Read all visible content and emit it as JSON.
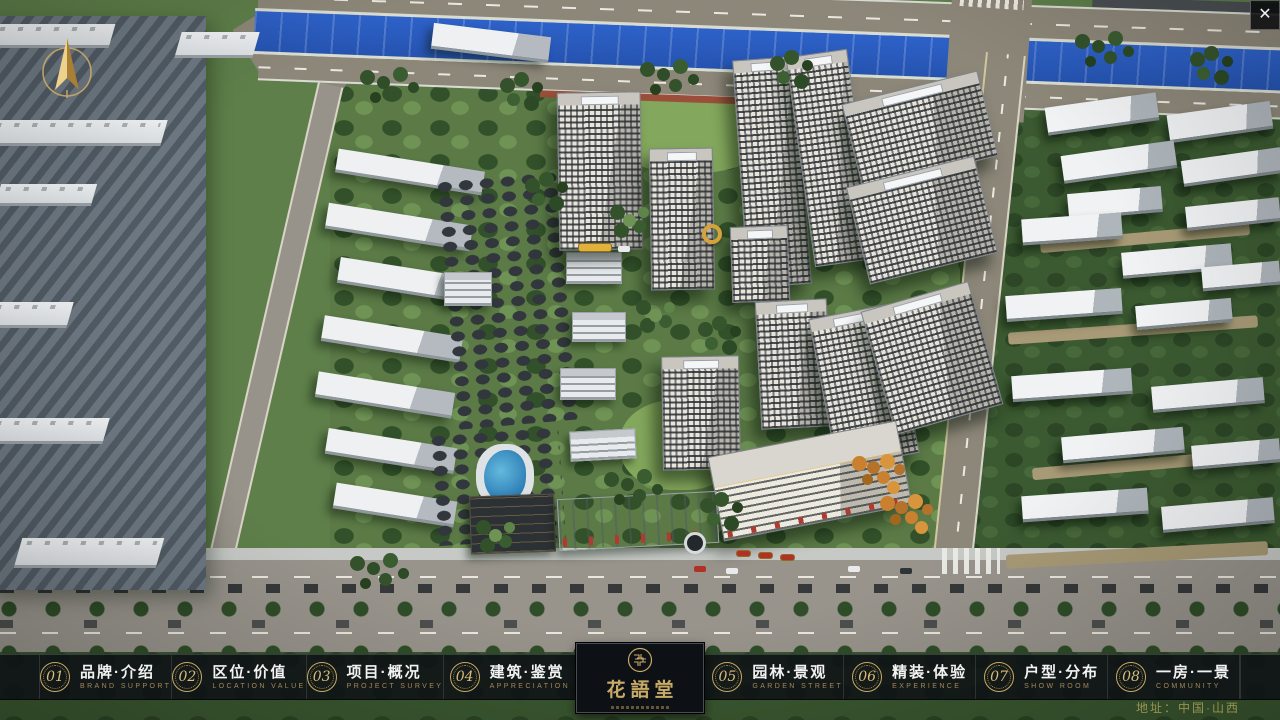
{
  "colors": {
    "accent_gold": "#c8aa66",
    "nav_background": "rgba(13,17,21,0.85)",
    "river_blue": "#2b5cc4",
    "title_white": "#f2f2f2",
    "subtitle_gold": "#a5875a"
  },
  "viewer": {
    "close_label": "✕",
    "address": "地址：中国·山西"
  },
  "logo": {
    "name": "花語堂"
  },
  "nav": {
    "items": [
      {
        "num": "01",
        "title": "品牌·介绍",
        "subtitle": "BRAND SUPPORT"
      },
      {
        "num": "02",
        "title": "区位·价值",
        "subtitle": "LOCATION VALUE"
      },
      {
        "num": "03",
        "title": "项目·概况",
        "subtitle": "PROJECT SURVEY"
      },
      {
        "num": "04",
        "title": "建筑·鉴赏",
        "subtitle": "APPRECIATION"
      },
      {
        "num": "05",
        "title": "园林·景观",
        "subtitle": "GARDEN STREET"
      },
      {
        "num": "06",
        "title": "精装·体验",
        "subtitle": "EXPERIENCE"
      },
      {
        "num": "07",
        "title": "户型·分布",
        "subtitle": "SHOW ROOM"
      },
      {
        "num": "08",
        "title": "一房·一景",
        "subtitle": "COMMUNITY"
      }
    ]
  }
}
